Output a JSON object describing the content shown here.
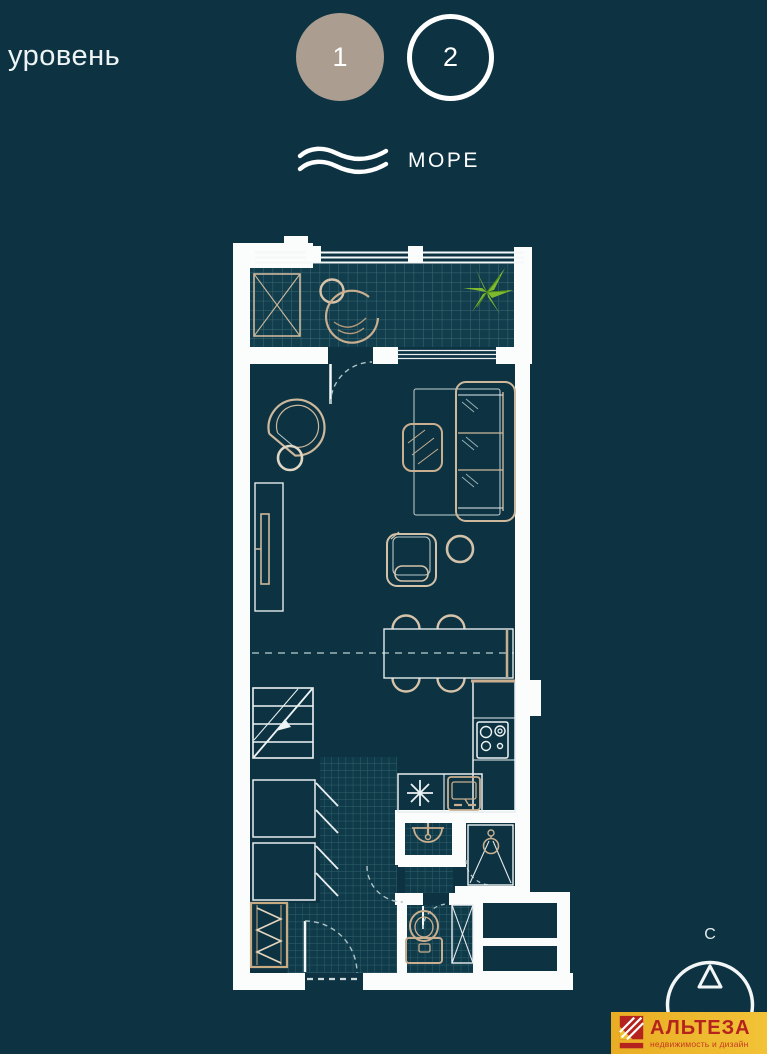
{
  "header": {
    "level_label": "уровень",
    "levels": [
      {
        "label": "1",
        "selected": true
      },
      {
        "label": "2",
        "selected": false
      }
    ],
    "sea_label": "МОРЕ"
  },
  "compass": {
    "north_label": "С"
  },
  "logo": {
    "title": "АЛЬТЕЗА",
    "subtitle": "недвижимость и дизайн"
  },
  "colors": {
    "background": "#0d3342",
    "wall_white": "#fbfdfd",
    "furniture_beige": "#c9ae8f",
    "selected_level_fill": "#ab9d90",
    "plant_green": "#7fb92e",
    "tile_line": "#3d6a75",
    "logo_background": "#eeb62e",
    "logo_red": "#b5231f"
  },
  "floor_plan": {
    "selected_level": "1",
    "furniture_icons": [
      "balcony-railing",
      "balcony-tiles",
      "ac-unit",
      "hanging-chair",
      "plant",
      "sliding-window",
      "balcony-door",
      "armchair",
      "side-table",
      "tv-console",
      "rug",
      "sofa",
      "coffee-table",
      "lounge-chair",
      "dining-table",
      "dining-chairs",
      "level-change-dashed-line",
      "stairs",
      "wardrobe",
      "coat-rack",
      "kitchen-counter",
      "cooktop",
      "kitchen-sink",
      "washbasin",
      "shower",
      "toilet",
      "tall-cabinet",
      "entrance-door"
    ]
  }
}
